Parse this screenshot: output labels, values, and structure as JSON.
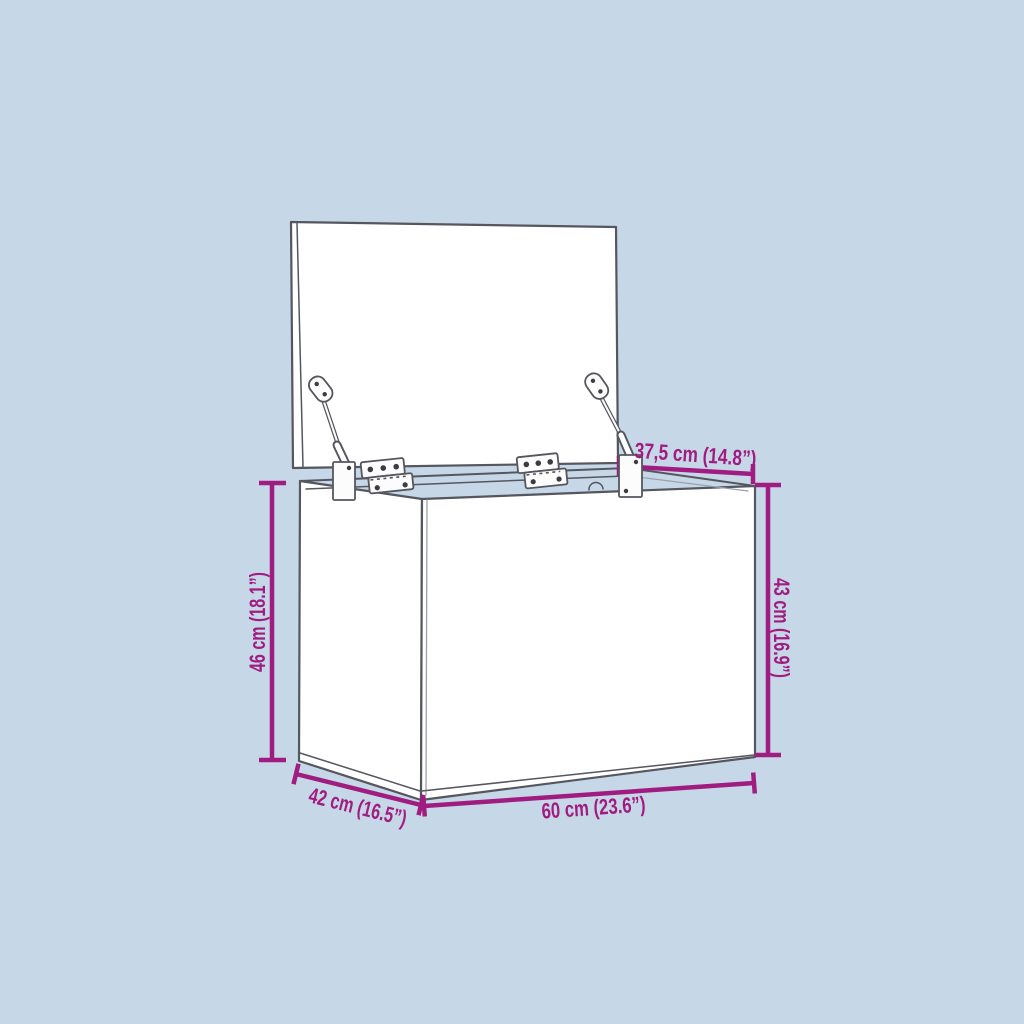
{
  "diagram": {
    "type": "product-dimension-drawing",
    "subject": "storage box with open lid, two hinges and two gas struts",
    "colors": {
      "background": "#c6d8e7",
      "line": "#55565e",
      "dimension": "#a11c80"
    },
    "dimensions": {
      "top_depth": {
        "label": "37,5 cm (14.8”)"
      },
      "left_height": {
        "label": "46 cm (18.1”)"
      },
      "right_height": {
        "label": "43 cm (16.9”)"
      },
      "bottom_depth": {
        "label": "42 cm (16.5”)"
      },
      "bottom_width": {
        "label": "60 cm (23.6”)"
      }
    }
  }
}
